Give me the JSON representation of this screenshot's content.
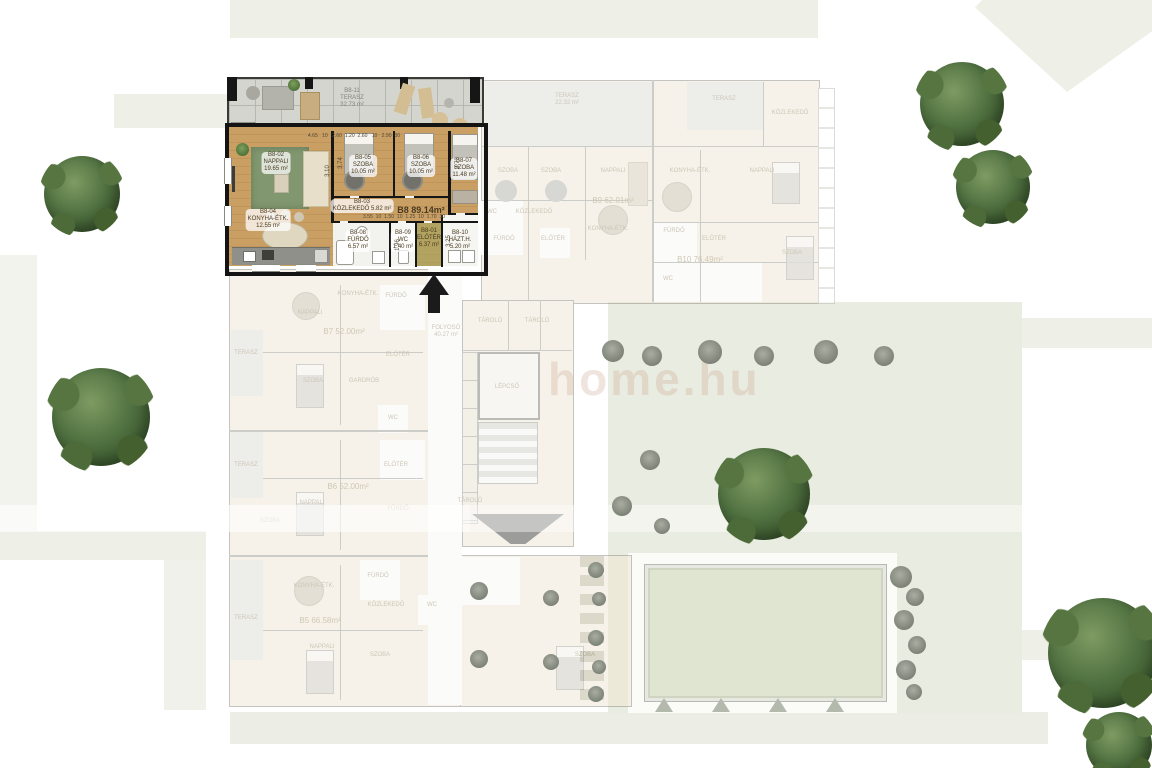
{
  "watermark": {
    "text": "home.hu"
  },
  "b8": {
    "total": "B8 89.14m²",
    "klima": "KLÍMA",
    "terrace": {
      "code": "B8-11",
      "name": "TERASZ",
      "area": "32.73 m²"
    },
    "rooms": {
      "nappali": {
        "code": "B8-02",
        "name": "NAPPALI",
        "area": "19.65 m²"
      },
      "szoba1": {
        "code": "B8-05",
        "name": "SZOBA",
        "area": "10.05 m²"
      },
      "szoba2": {
        "code": "B8-06",
        "name": "SZOBA",
        "area": "10.05 m²"
      },
      "szoba3": {
        "code": "B8-07",
        "name": "SZOBA",
        "area": "11.48 m²"
      },
      "konyha": {
        "code": "B8-04",
        "name": "KONYHA-ÉTK.",
        "area": "12.55 m²"
      },
      "kozlekedo": {
        "code": "B8-03",
        "name": "KÖZLEKEDŐ",
        "area": "5.82 m²"
      },
      "furdo": {
        "code": "B8-08",
        "name": "FÜRDŐ",
        "area": "6.57 m²"
      },
      "wc": {
        "code": "B8-09",
        "name": "WC",
        "area": "1.40 m²"
      },
      "eloter": {
        "code": "B8-01",
        "name": "ELŐTÉR",
        "area": "6.37 m²"
      },
      "hazth": {
        "code": "B8-10",
        "name": "HÁZT.H.",
        "area": "5.20 m²"
      }
    },
    "dims": {
      "top": "4.65   10   2.60  1.20  2.60   10   2.90  30",
      "bottom": "3.55  10  1.50  10  1.25  10  1.70  30",
      "left_v": "3.10",
      "v1": "3.74",
      "v2": "3.73",
      "v3": "1.96",
      "v4": "3.25"
    }
  },
  "units": {
    "b9": "B9 62.01m²",
    "b10": "B10 76.49m²",
    "b7": "B7 52.00m²",
    "b6": "B6 52.00m²",
    "b5": "B5 66.58m²"
  },
  "names": {
    "szoba": "SZOBA",
    "nappali": "NAPPALI",
    "konyha": "KONYHA-ÉTK.",
    "furdo": "FÜRDŐ",
    "wc": "WC",
    "eloter": "ELŐTÉR",
    "kozlekedo": "KÖZLEKEDŐ",
    "terasz": "TERASZ",
    "gardrob": "GARDRÓB",
    "tarolo": "TÁROLÓ",
    "lepcso": "LÉPCSŐ",
    "folyoso": "FOLYOSÓ"
  },
  "areas": {
    "folyoso": "40.27 m²",
    "b9_terasz": "22.32 m²"
  }
}
